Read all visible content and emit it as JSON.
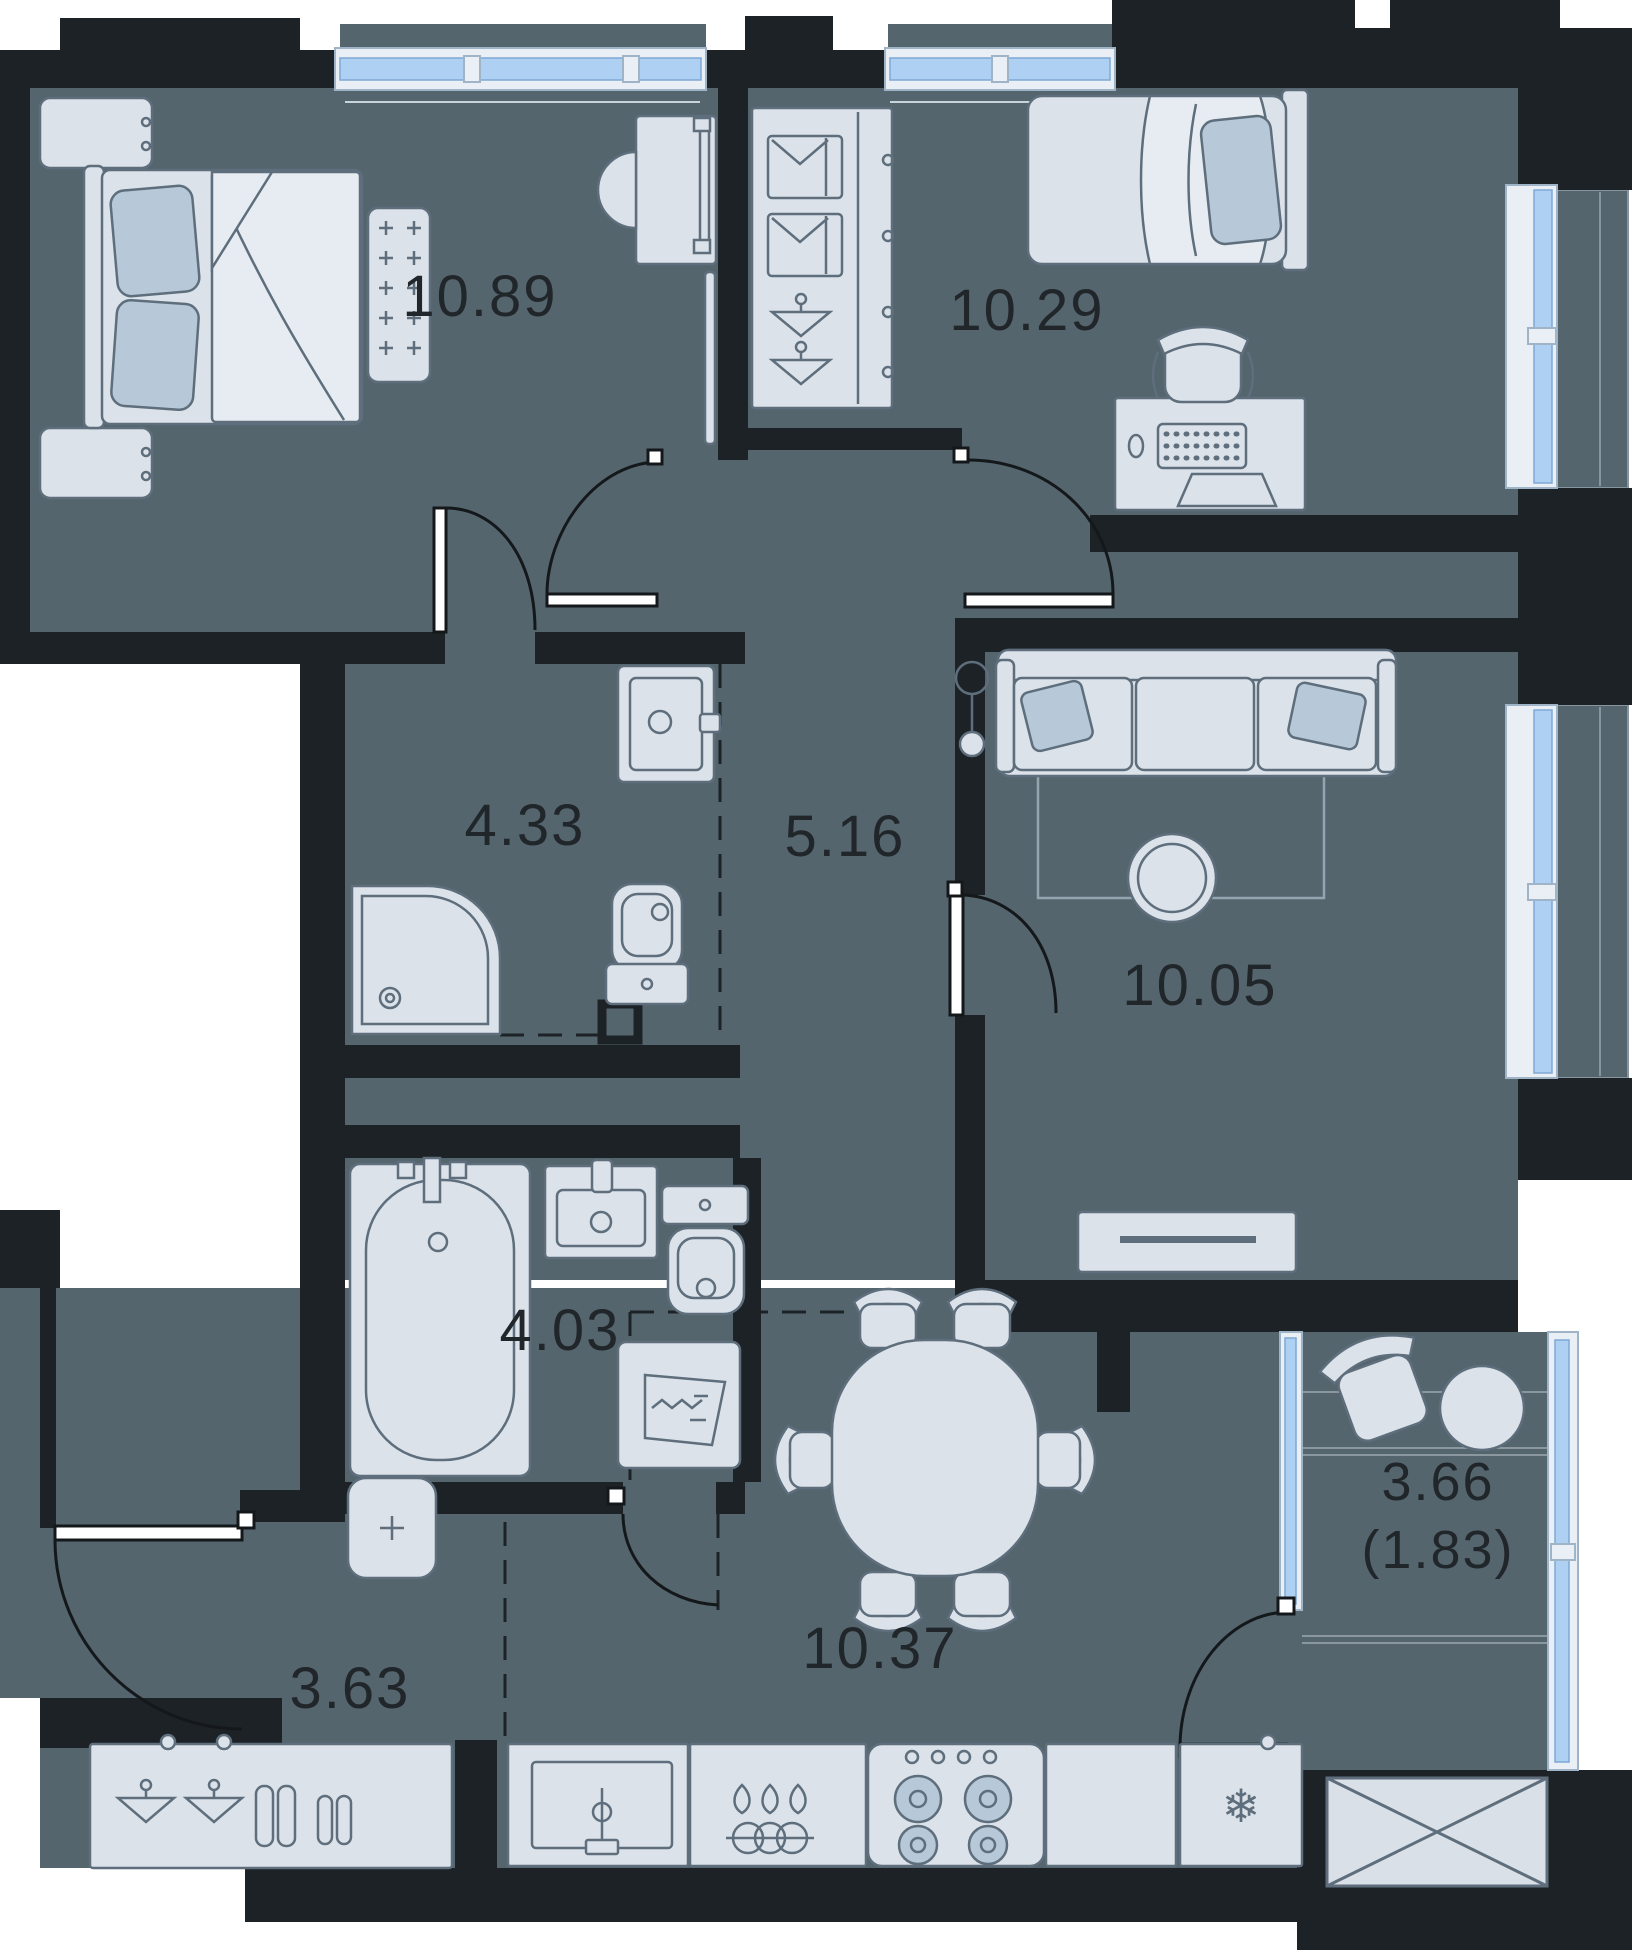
{
  "floorplan": {
    "type": "apartment-floor-plan",
    "area_unit": "m2",
    "colors": {
      "floor": "#54656e",
      "wall": "#1d2226",
      "furniture": "#dbe2e9",
      "furniture-light": "#e6ecf1",
      "accent": "#b7c9d8",
      "outline": "#5e6e7c",
      "glass": "#aed0f2",
      "frame": "#e9eff5",
      "frame-stroke": "#9fb4c6",
      "door": "#14181b",
      "label": "#21262a",
      "plank": "#8a979f"
    },
    "icons": {
      "snowflake": "❄"
    },
    "rooms": [
      {
        "key": "bedroom-1",
        "area_label": "10.89"
      },
      {
        "key": "bedroom-2",
        "area_label": "10.29"
      },
      {
        "key": "bathroom-1",
        "area_label": "4.33"
      },
      {
        "key": "hallway",
        "area_label": "5.16"
      },
      {
        "key": "living-room",
        "area_label": "10.05"
      },
      {
        "key": "bathroom-2",
        "area_label": "4.03"
      },
      {
        "key": "kitchen-dining",
        "area_label": "10.37"
      },
      {
        "key": "entry-hall",
        "area_label": "3.63"
      },
      {
        "key": "balcony",
        "area_label": "3.66",
        "area_label_secondary": "(1.83)"
      }
    ]
  }
}
